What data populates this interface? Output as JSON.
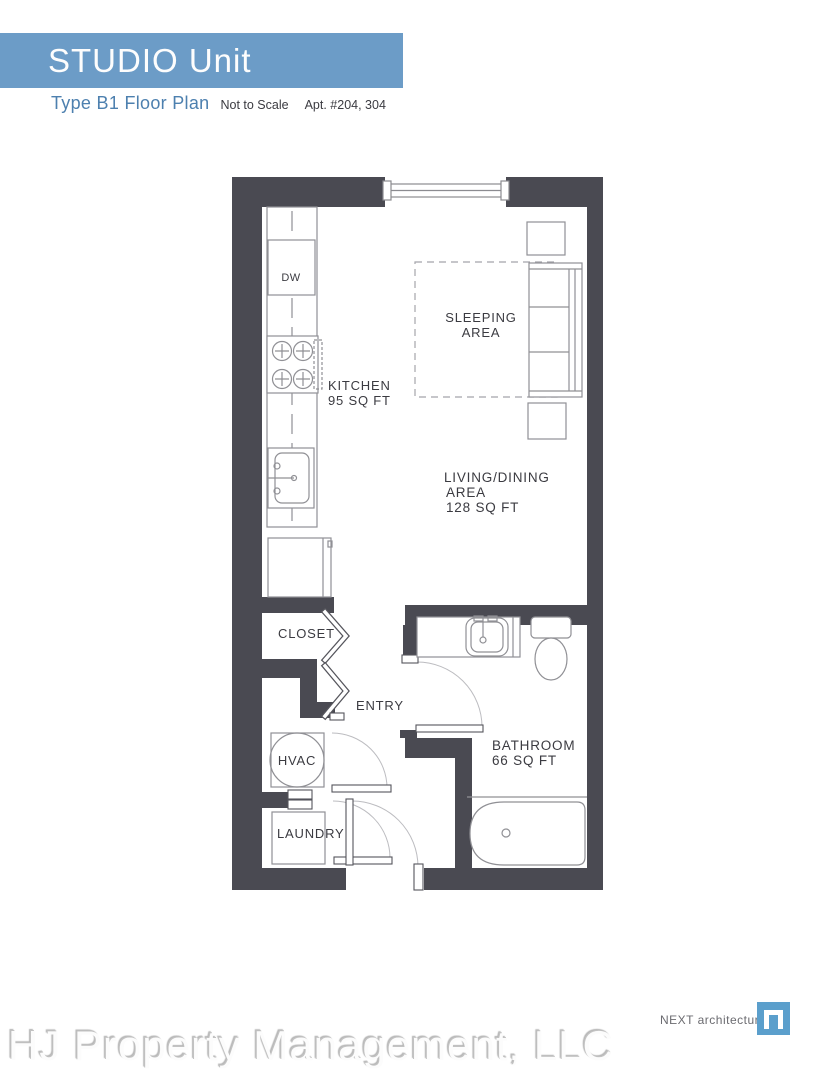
{
  "header": {
    "banner_title": "STUDIO Unit",
    "plan_type": "Type B1 Floor Plan",
    "scale_note": "Not to Scale",
    "apartment_numbers": "Apt. #204, 304"
  },
  "floor_plan": {
    "labels": {
      "dishwasher": "DW",
      "kitchen": "KITCHEN",
      "kitchen_area": "95 SQ FT",
      "sleeping_line1": "SLEEPING",
      "sleeping_line2": "AREA",
      "living_line1": "LIVING/DINING",
      "living_line2": "AREA",
      "living_area": "128 SQ FT",
      "closet": "CLOSET",
      "entry": "ENTRY",
      "hvac": "HVAC",
      "laundry": "LAUNDRY",
      "bathroom": "BATHROOM",
      "bathroom_area": "66 SQ FT"
    }
  },
  "footer": {
    "architect": "NEXT architecture",
    "company": "HJ Property Management, LLC"
  },
  "colors": {
    "banner_blue": "#6c9cc7",
    "accent_blue": "#4d80af",
    "wall_gray": "#4a4a52",
    "fixture_line_gray": "#909095",
    "logo_blue": "#5b9fcc"
  }
}
